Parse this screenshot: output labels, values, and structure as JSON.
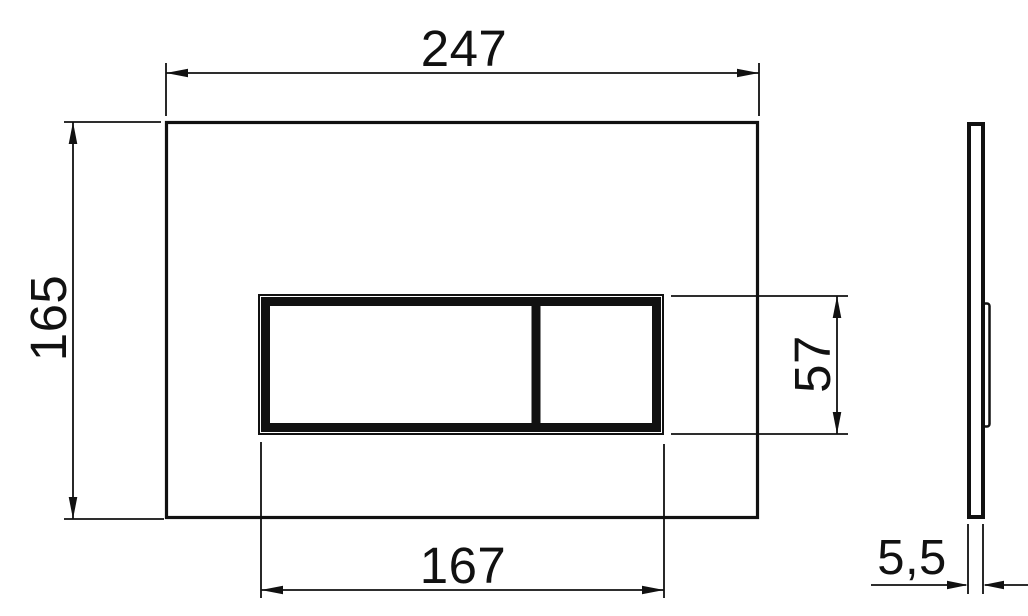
{
  "diagram": {
    "title": "flush-plate dimension drawing, front and side views",
    "dimensions": {
      "overall_width": "247",
      "overall_height": "165",
      "button_panel_width": "167",
      "button_panel_height": "57",
      "thickness": "5,5"
    },
    "colors": {
      "line": "#111111",
      "background": "#ffffff"
    }
  }
}
